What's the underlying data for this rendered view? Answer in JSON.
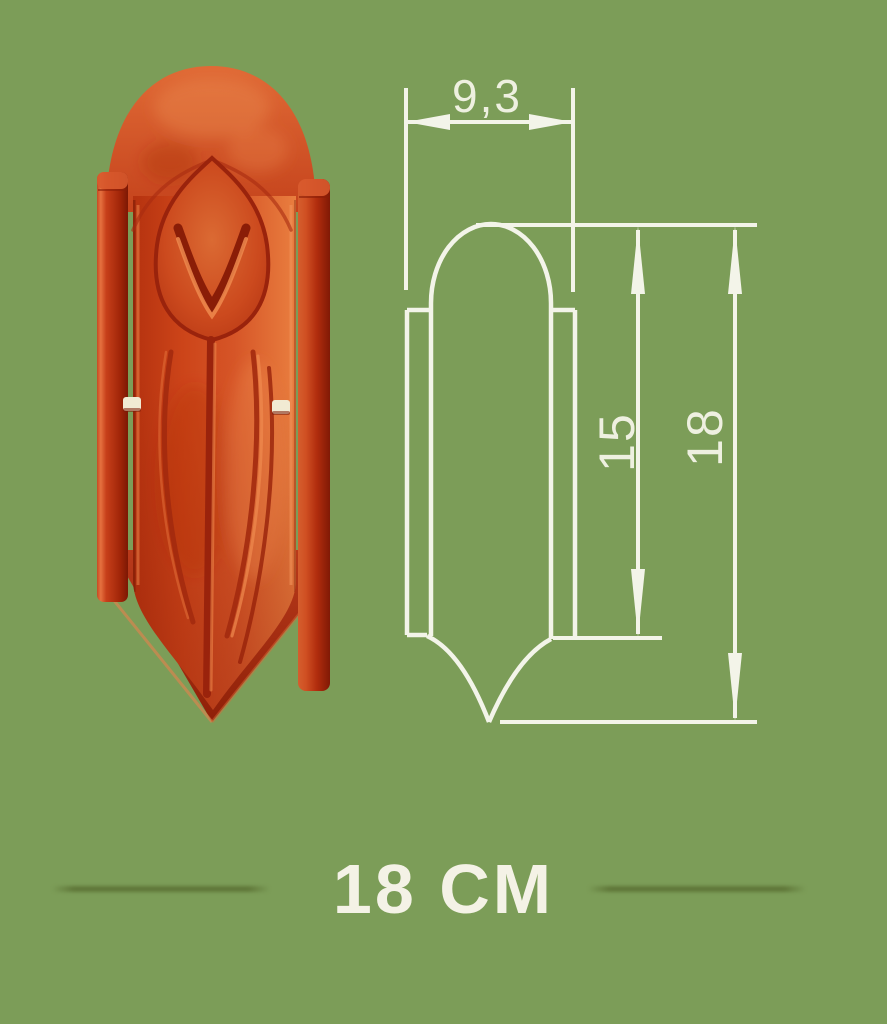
{
  "background_color": "#7c9d58",
  "photo": {
    "description": "red clay decorative ridge tile with tulip relief, arched top, side flanges, pointed bottom, two nail holes",
    "tile_main_color": "#cf4a1f",
    "tile_dark_color": "#8a1d07",
    "tile_highlight_color": "#ef8a4e",
    "nail_hole_color": "#f1ead3"
  },
  "drawing": {
    "description": "white technical profile drawing of the tile with dimension lines",
    "line_color": "#f3f4e9",
    "width_label": "9,3",
    "inner_height_label": "15",
    "total_height_label": "18"
  },
  "caption": {
    "size_text": "18 CM",
    "text_color": "#f4f2e6",
    "divider_color": "#5f7638"
  }
}
